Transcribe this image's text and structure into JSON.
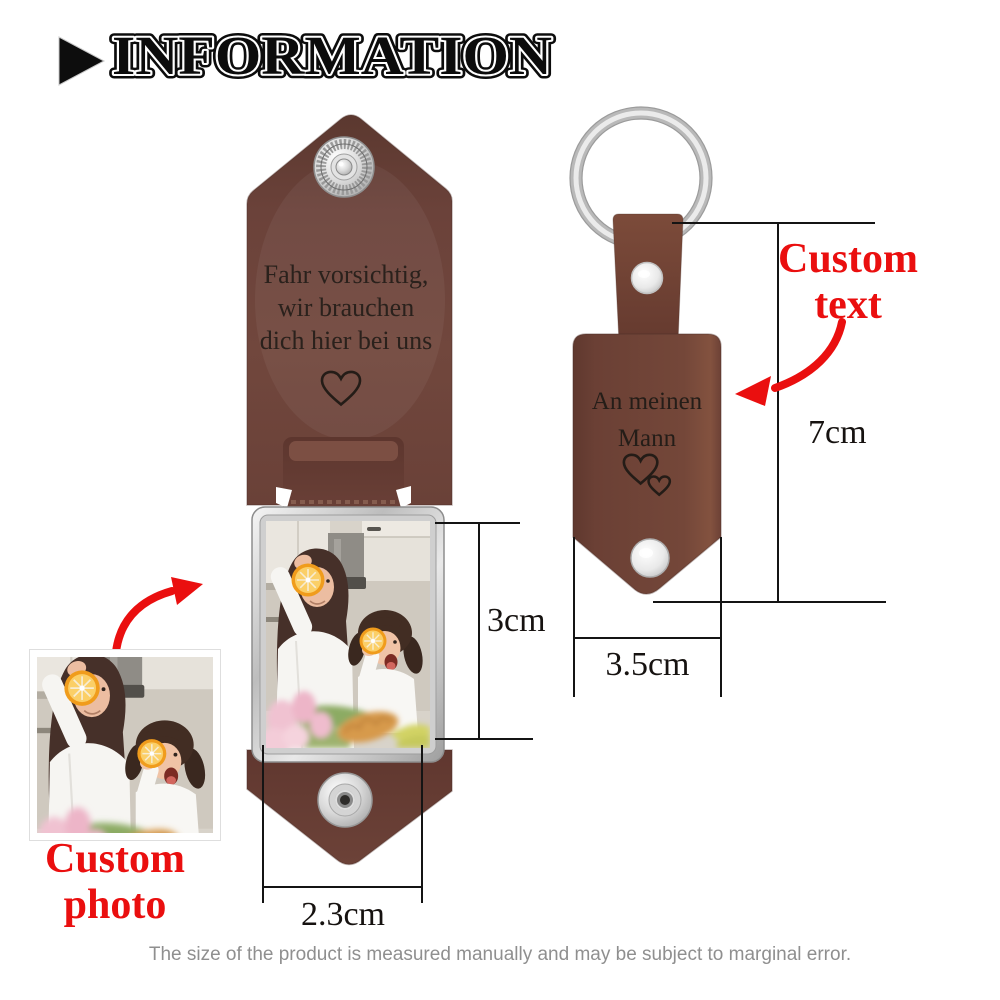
{
  "header": {
    "title": "INFORMATION"
  },
  "left_keychain": {
    "engraving": [
      "Fahr vorsichtig,",
      "wir brauchen",
      "dich hier bei uns"
    ],
    "photo_height_label": "3cm",
    "photo_width_label": "2.3cm"
  },
  "right_keychain": {
    "engraving": [
      "An meinen",
      "Mann"
    ],
    "height_label": "7cm",
    "width_label": "3.5cm"
  },
  "annotations": {
    "custom_text": [
      "Custom",
      "text"
    ],
    "custom_photo": [
      "Custom",
      "photo"
    ]
  },
  "footer": {
    "disclaimer": "The size of the product is measured manually and may be subject to marginal error."
  },
  "colors": {
    "accent_red": "#ea0f0f",
    "leather_brown": "#6e463c",
    "metal_silver": "#c9c9c9",
    "engraving_ink": "#241d18"
  }
}
